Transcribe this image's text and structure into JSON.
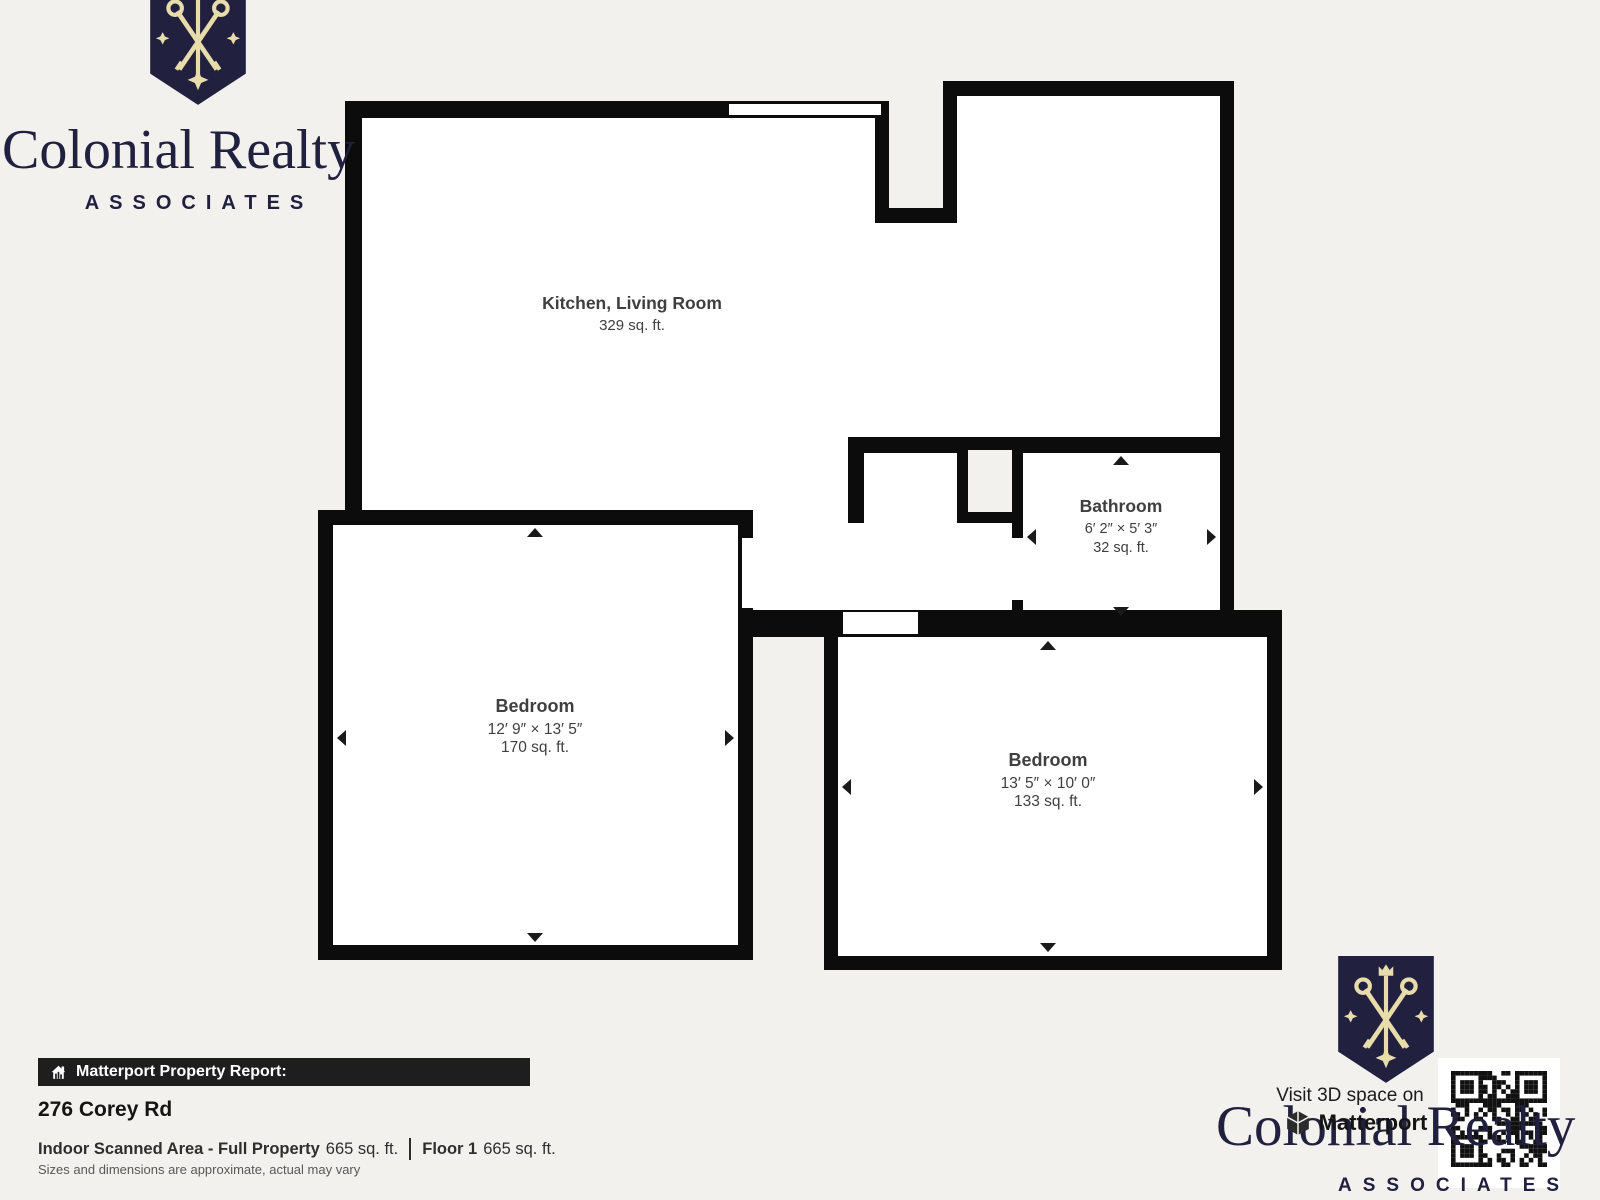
{
  "branding": {
    "name": "Colonial Realty",
    "sub": "ASSOCIATES"
  },
  "floor_plan": {
    "rooms": [
      {
        "name": "Kitchen, Living Room",
        "dims": "",
        "area": "329 sq. ft."
      },
      {
        "name": "Bathroom",
        "dims": "6′ 2″ × 5′ 3″",
        "area": "32 sq. ft."
      },
      {
        "name": "Bedroom",
        "dims": "12′ 9″ × 13′ 5″",
        "area": "170 sq. ft."
      },
      {
        "name": "Bedroom",
        "dims": "13′ 5″ × 10′ 0″",
        "area": "133 sq. ft."
      }
    ]
  },
  "report": {
    "bar_label": "Matterport Property Report:",
    "address": "276 Corey Rd",
    "scanned_label": "Indoor Scanned Area - Full Property",
    "scanned_value": "665 sq. ft.",
    "floor_label": "Floor 1",
    "floor_value": "665 sq. ft.",
    "disclaimer": "Sizes and dimensions are approximate, actual may vary"
  },
  "cta": {
    "line1": "Visit 3D space on",
    "line2": "Matterport"
  },
  "colors": {
    "navy": "#21213f",
    "gold": "#e9dcab",
    "wall": "#0c0c0c",
    "background": "#f2f1ee",
    "room_text": "#3f3f3f",
    "report_bar_bg": "#1e1e1e"
  },
  "icons": {
    "report_bar": "house-icon",
    "cta": "matterport-cube-icon",
    "logo": "crest-keys-icon",
    "qr": "qr-code"
  }
}
